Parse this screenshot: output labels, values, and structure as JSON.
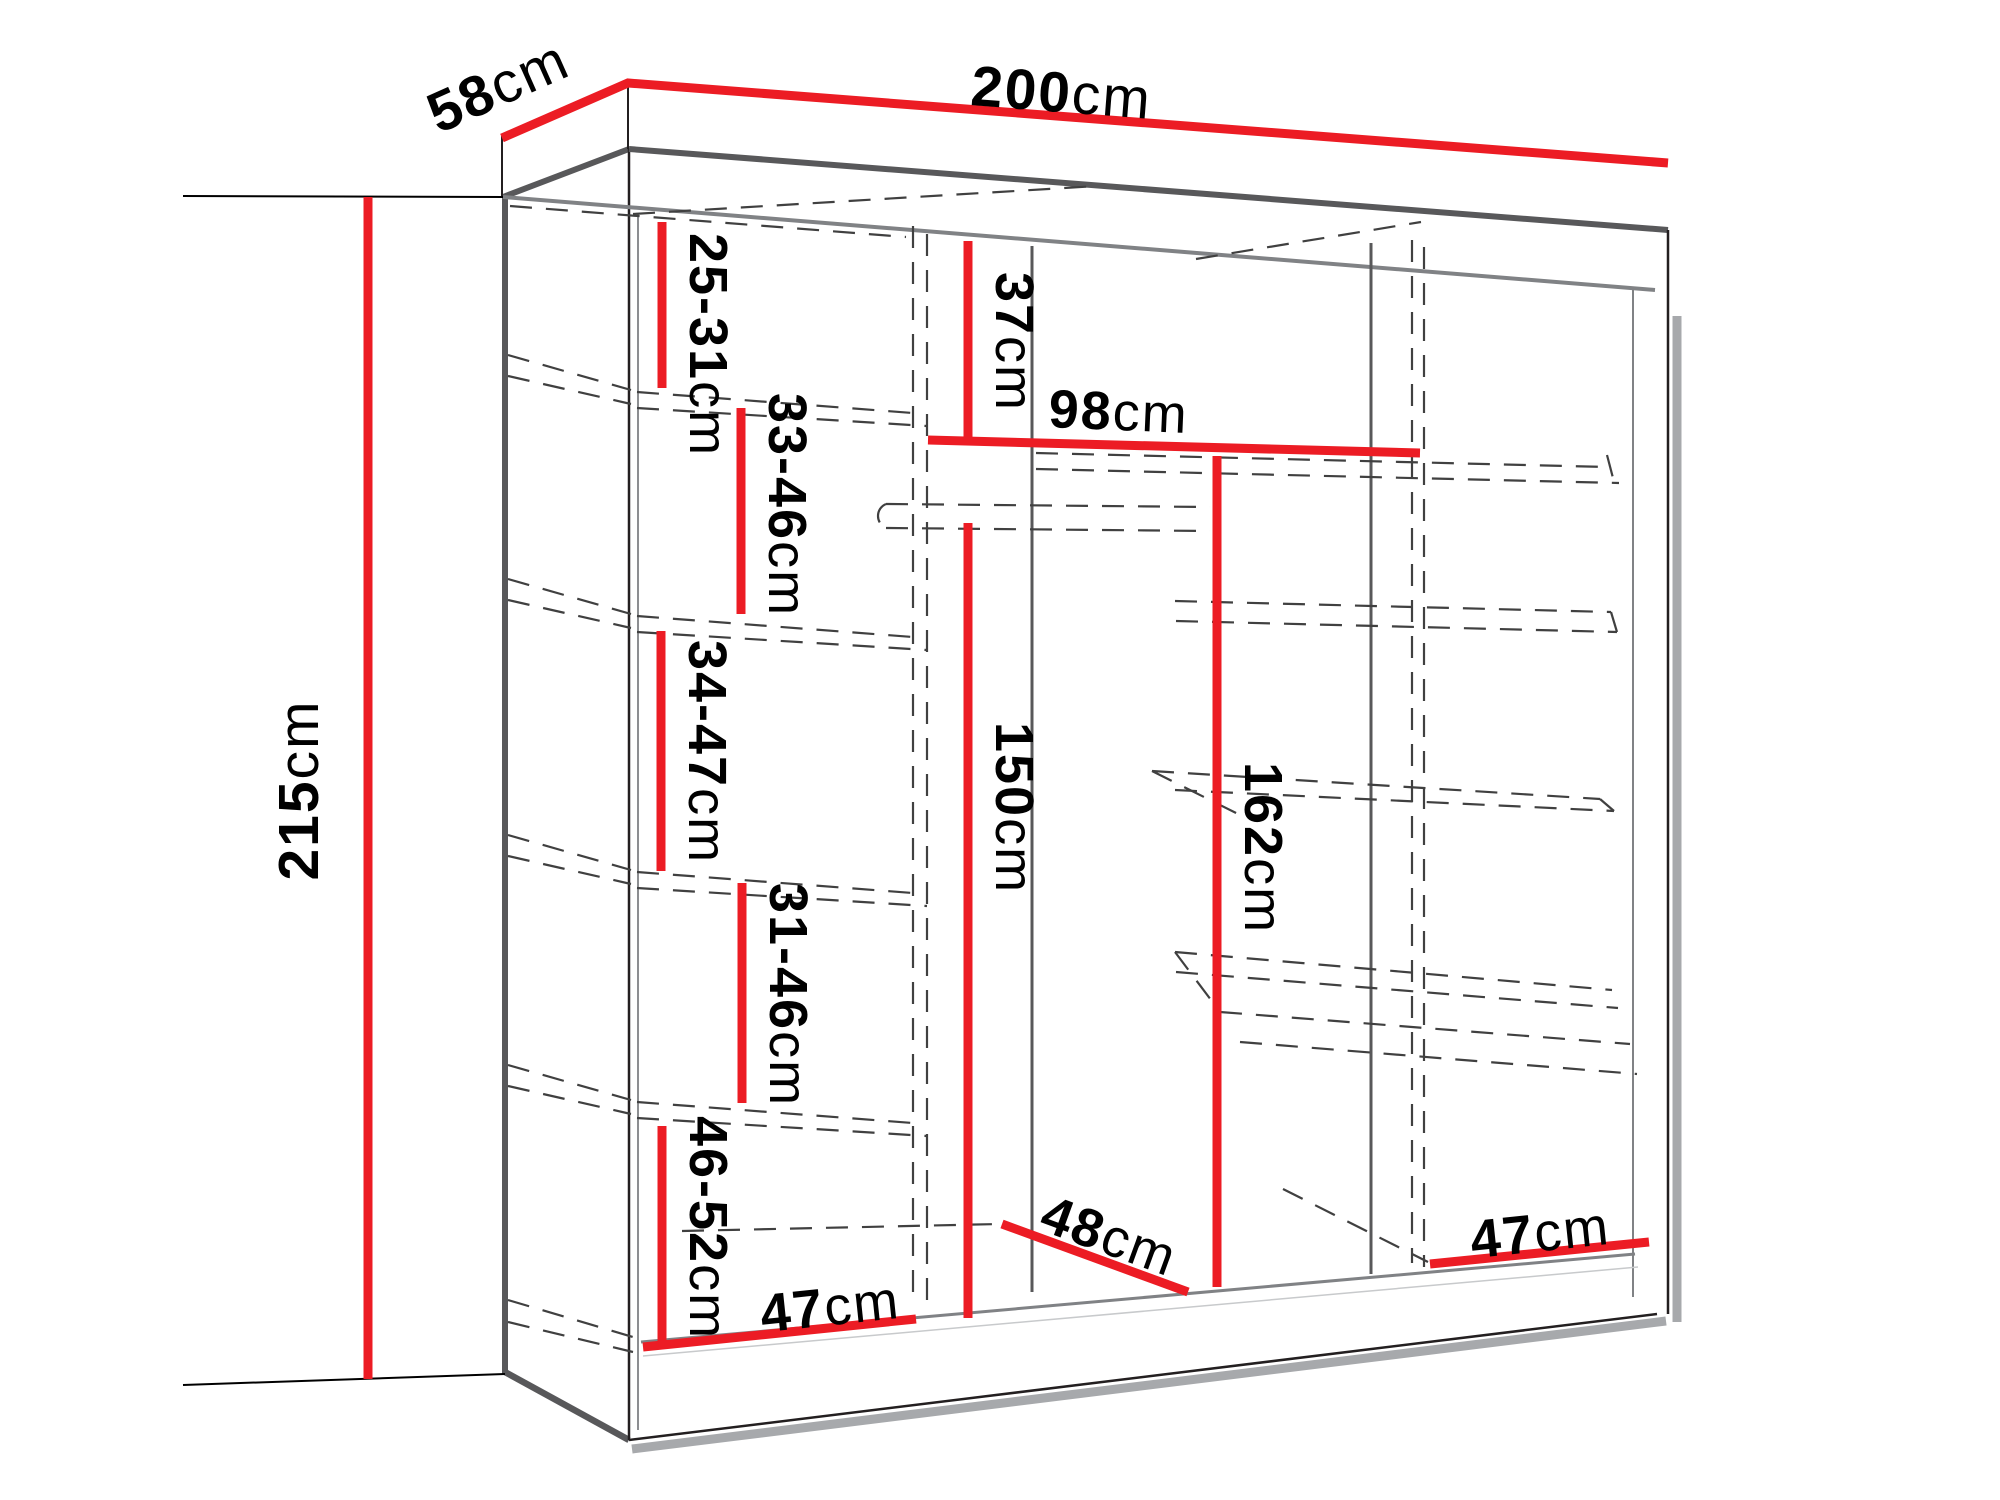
{
  "diagram": {
    "type": "furniture-dimension-diagram",
    "subject": "wardrobe interior dimensions, perspective line drawing",
    "colors": {
      "background": "#ffffff",
      "dimension_line": "#ec1c24",
      "outline_dark": "#58585a",
      "outline_thin": "#231f20",
      "outline_mid": "#808285",
      "shadow": "#a7a9ac",
      "dashed": "#404040",
      "text": "#000000"
    },
    "labels": {
      "width": {
        "value": "200",
        "unit": "cm"
      },
      "depth": {
        "value": "58",
        "unit": "cm"
      },
      "height": {
        "value": "215",
        "unit": "cm"
      },
      "left_gap_1": {
        "value": "25-31",
        "unit": "cm"
      },
      "left_gap_2": {
        "value": "33-46",
        "unit": "cm"
      },
      "left_gap_3": {
        "value": "34-47",
        "unit": "cm"
      },
      "left_gap_4": {
        "value": "31-46",
        "unit": "cm"
      },
      "left_gap_5": {
        "value": "46-52",
        "unit": "cm"
      },
      "top_shelf_drop": {
        "value": "37",
        "unit": "cm"
      },
      "middle_shelf_width": {
        "value": "98",
        "unit": "cm"
      },
      "clearance_middle": {
        "value": "150",
        "unit": "cm"
      },
      "clearance_right": {
        "value": "162",
        "unit": "cm"
      },
      "floor_depth_middle": {
        "value": "48",
        "unit": "cm"
      },
      "floor_width_left": {
        "value": "47",
        "unit": "cm"
      },
      "floor_width_right": {
        "value": "47",
        "unit": "cm"
      }
    }
  }
}
